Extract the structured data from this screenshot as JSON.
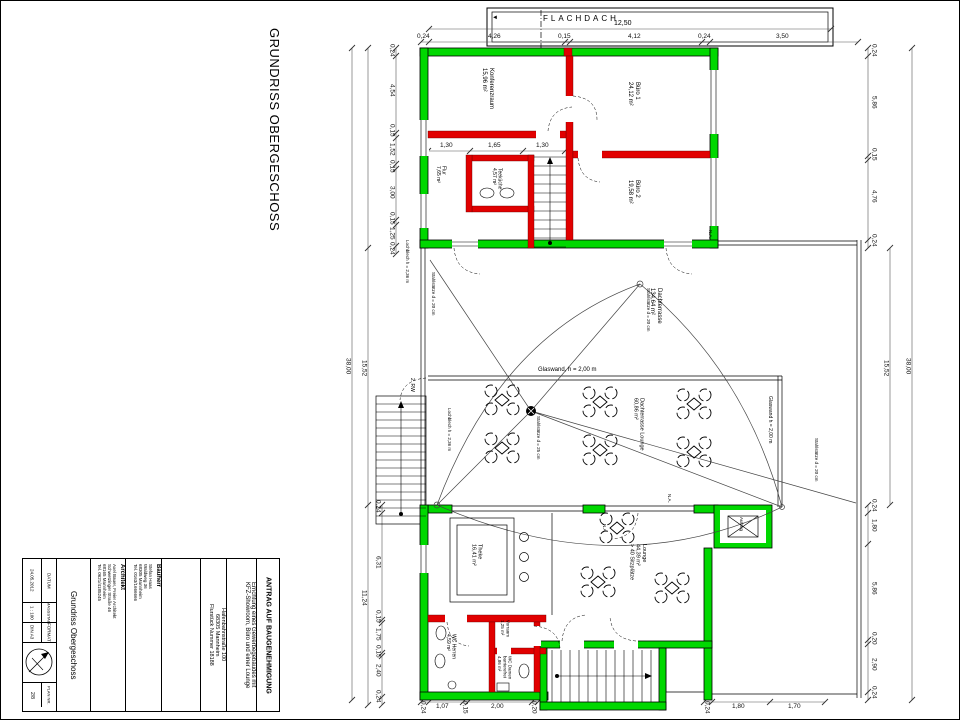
{
  "sheet": {
    "main_title": "GRUNDRISS OBERGESCHOSS"
  },
  "title_block": {
    "antrag": "ANTRAG AUF BAUGENEHMIGUNG",
    "project_line1": "Errichtung eines Gewerbegebäudes mit",
    "project_line2": "KFZ-Showroom, Büro und einer Lounge",
    "site_line1": "Hafenbahnstraße 100",
    "site_line2": "68305 Mannheim",
    "site_line3": "Flurstück Nummer 18188",
    "bauherr_label": "Bauherr",
    "bauherr_line1": "Stefan Haas",
    "bauherr_line2": "Waldweg 36",
    "bauherr_line3": "68305 Mannheim",
    "bauherr_line4": "Tel. 0163/1666666",
    "architekt_label": "Architekt",
    "architekt_line1": "Axel Bauer, Freier Architekt",
    "architekt_line2": "Schwetzinger Straße 46",
    "architekt_line3": "68165 Mannheim",
    "architekt_line4": "Tel. 0621/4185245",
    "plan_name": "Grundriss Obergeschoss",
    "datum_label": "DATUM",
    "datum_value": "24.05.2012",
    "massstab_label": "MASSSTAB",
    "massstab_value": "1 : 100",
    "format_label": "FORMAT",
    "format_value": "DIN A3",
    "plannr_label": "PLAN NR.",
    "plannr_value": "2/8"
  },
  "plan": {
    "flachdach": {
      "label": "FLACHDACH",
      "arrow": "◄",
      "total": "12,50"
    },
    "rooms": {
      "konferenzraum": {
        "name": "Konferenzraum",
        "area": "15,96 m²"
      },
      "buero1": {
        "name": "Büro 1",
        "area": "24,12 m²"
      },
      "buero2": {
        "name": "Büro 2",
        "area": "19,58 m²"
      },
      "flur": {
        "name": "Flur",
        "area": "7,65 m²"
      },
      "teekueche": {
        "name": "Teeküche",
        "area": "4,57 m²"
      },
      "dachterrasse": {
        "name": "Dachterrasse",
        "area": "134,64 m²"
      },
      "dachterrasse_lounge": {
        "name": "Dachterrasse Lounge",
        "area": "60,86 m²"
      },
      "theke": {
        "name": "Theke",
        "area": "16,41 m²"
      },
      "lounge": {
        "name": "Lounge",
        "area": "44,39 m²",
        "note": "> 40 Sitzplätze"
      },
      "wc_herren": {
        "name": "WC Herren",
        "area": "4,59 m²"
      },
      "vorraum": {
        "name": "Vorraum",
        "area": "1,25 m²"
      },
      "wc_damen": {
        "name": "WC Damen",
        "name2": "barrierefrei",
        "area": "4,86 m²"
      }
    },
    "annotations": {
      "glaswand_h": "Glaswand, h = 2,00 m",
      "glaswand_v": "Glaswand h = 2,00 m",
      "stahlstuetze_25": "Stahlstütze d = 25 cm",
      "stahlstuetze_20": "Stahlstütze d = 20 cm",
      "lochblech": "Lochblech h = 2,36 m",
      "rettungsweg": "2. RW",
      "aufzug": "Aufzug",
      "na": "N.A."
    },
    "dims": {
      "top": [
        "0,24",
        "4,26",
        "0,15",
        "4,12",
        "0,24",
        "3,50"
      ],
      "flur_chain": [
        "1,30",
        "1,65",
        "1,30"
      ],
      "left_upper": [
        "0,24",
        "4,54",
        "0,15",
        "1,52",
        "0,15",
        "3,00",
        "0,15",
        "1,25",
        "0,24"
      ],
      "left_lower": [
        "0,24",
        "6,31",
        "0,15",
        "1,75",
        "0,15",
        "2,40",
        "0,24"
      ],
      "left_mid_terrace": "15,52",
      "left_mid_lower": "11,24",
      "left_total": "38,00",
      "right_upper": [
        "0,24",
        "5,86",
        "0,15",
        "4,76",
        "0,24"
      ],
      "right_lower": [
        "0,24",
        "1,80",
        "5,86",
        "0,20",
        "2,90",
        "0,24"
      ],
      "right_mid": "15,52",
      "right_total": "38,00",
      "bottom_left": [
        "0,24",
        "1,07",
        "0,15",
        "2,00",
        "0,20"
      ],
      "bottom_right": [
        "0,24",
        "1,80",
        "1,70"
      ]
    }
  }
}
